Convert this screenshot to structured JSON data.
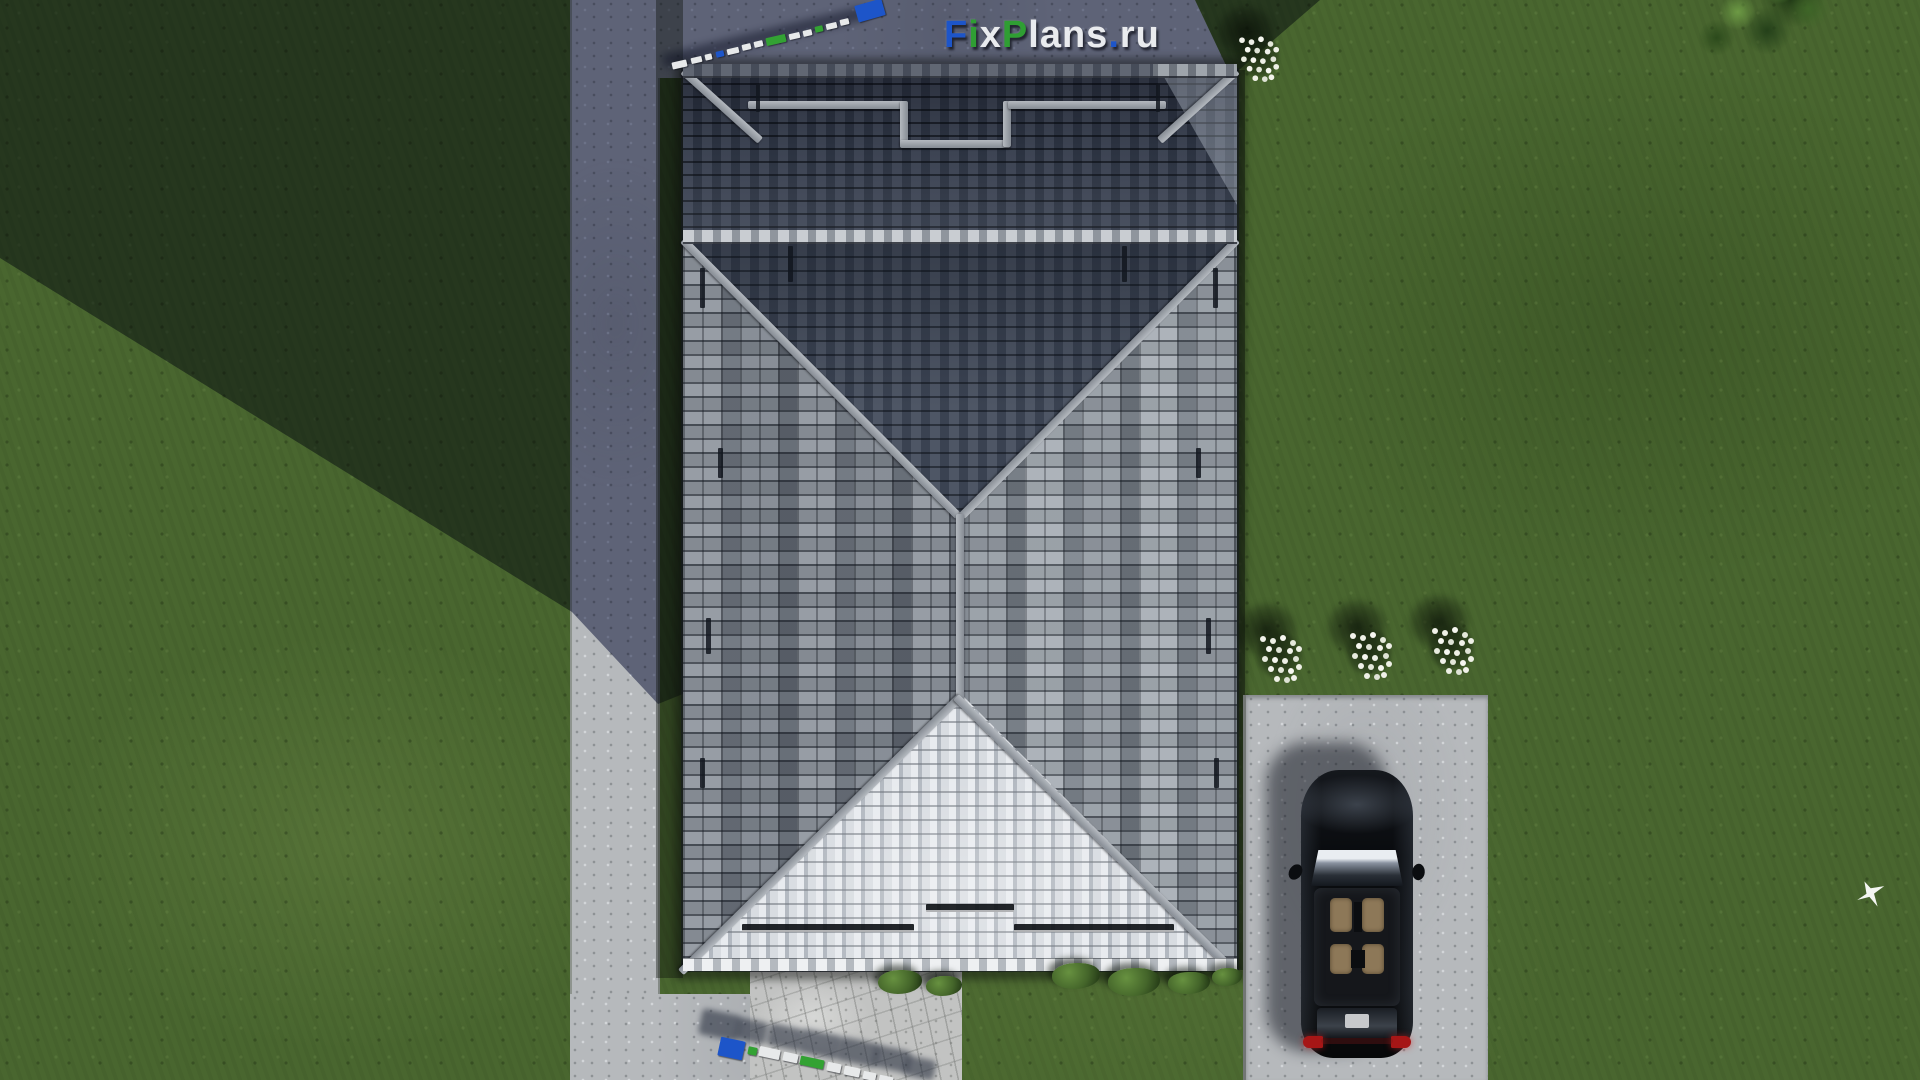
{
  "watermark": {
    "text": "FixPlans.ru",
    "segments": [
      {
        "t": "F",
        "c": "#1d55c9"
      },
      {
        "t": "i",
        "c": "#2f9e33"
      },
      {
        "t": "x",
        "c": "#e9ebee"
      },
      {
        "t": "P",
        "c": "#2f9e33"
      },
      {
        "t": "lans",
        "c": "#e9ebee"
      },
      {
        "t": ".",
        "c": "#1d55c9"
      },
      {
        "t": "ru",
        "c": "#e9ebee"
      }
    ]
  },
  "scene": {
    "description": "Aerial top-down 3D render of a house with a gray hipped tile roof on a lawn; concrete path on the left, driveway with a parked black car on the right, white flower bushes, green shrubs, a tree canopy at top right, a flying white bird, and FixPlans.ru watermarks (flat logo and two 3D standing-letter block marks with cast shadows).",
    "objects": [
      {
        "name": "hip-roof-house"
      },
      {
        "name": "garage-roof-wing-in-shadow"
      },
      {
        "name": "concrete-path-left"
      },
      {
        "name": "concrete-terrace-top"
      },
      {
        "name": "stone-patio-bottom"
      },
      {
        "name": "driveway"
      },
      {
        "name": "black-car",
        "facing": "up",
        "taillights": "red"
      },
      {
        "name": "flower-bush",
        "count": 4,
        "flower_color": "#f1f2ea"
      },
      {
        "name": "green-shrub",
        "count": 6
      },
      {
        "name": "tree-canopy"
      },
      {
        "name": "white-bird"
      },
      {
        "name": "house-cast-shadow",
        "direction": "upper-left"
      },
      {
        "name": "3d-watermark-blocks",
        "count": 2,
        "text": "FixPlans.ru"
      }
    ],
    "colors": {
      "grass_sunlit": "#49662f",
      "grass_shadow": "#273d1c",
      "concrete_sunlit": "#b6b9bc",
      "concrete_shadow": "#5f657a",
      "roof_tile_light": "#9aa0a8",
      "roof_tile_dark": "#3a4150",
      "roof_bottom_slope": "#d8dce1",
      "roof_ridge": "#9aa0a6",
      "car_body": "#0b0d11",
      "car_interior": "#8d7858",
      "car_taillight": "#a61616",
      "logo_blue": "#1d55c9",
      "logo_green": "#2f9e33",
      "logo_white": "#e9ebee"
    }
  }
}
